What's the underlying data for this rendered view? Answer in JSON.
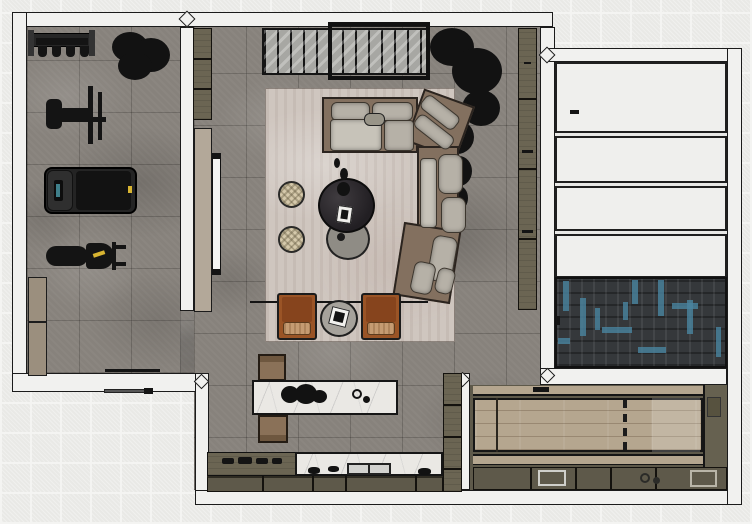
{
  "meta": {
    "view": "top-down-floorplan-render",
    "text_visible": "none"
  },
  "palette": {
    "bg0": "#f4f4f2",
    "bg1": "#e9e9e6",
    "ink": "#1b1b1b",
    "wall": "#f1f1ef",
    "stone": "#87827c",
    "rug": "#cfc6bf",
    "olive": "#6b6553",
    "olive2": "#5e594a",
    "sofa": "#83705f",
    "cushion": "#b6b1a7",
    "cushionL": "#c7c3b9",
    "leather": "#9a5426",
    "leatherD": "#86441d",
    "leatherS": "#c59b72",
    "pouf": "#d5c9ab",
    "tableDark": "#2c292c",
    "tableGray": "#8f8c85",
    "marble": "#eae8e4",
    "wood": "#b5a68f",
    "woodBench": "#8a7158",
    "tan": "#b3a899",
    "tv": "#f4f4f2",
    "herrBase": "#35383b",
    "herrTeal": "#4a84a0",
    "slab": "#efefed",
    "yellow": "#d8b431"
  },
  "scene": {
    "rooms": {
      "gym": "gym room",
      "living": "living room",
      "kitchen": "kitchen zone",
      "stair_hall": "stair hall",
      "entry": "parquet entry",
      "utility": "utility room"
    },
    "items": {
      "weight_rack": "dumbbell rack",
      "gym_plant": "potted plant",
      "cable_machine": "cable weight machine",
      "treadmill": "treadmill",
      "workout_bench": "workout bench",
      "gym_cabinet": "storage cabinet",
      "wardrobe_nw": "tall cabinet",
      "slat_screen": "slatted screen",
      "window_frame": "framed window",
      "living_plant": "corner tree",
      "media_panel": "media wall panel",
      "tv": "wall tv",
      "rug": "area rug",
      "sofa": "sectional sofa",
      "pouf_1": "round pouf",
      "pouf_2": "round pouf",
      "coffee_table_dark": "round coffee table",
      "coffee_table_gray": "round side table",
      "armchair_left": "leather armchair",
      "armchair_right": "leather armchair",
      "side_table": "round occasional table",
      "bookshelf_east": "wall shelf unit",
      "island": "marble kitchen island",
      "island_bench_top": "wood stool",
      "island_bench_bottom": "wood stool",
      "cooktop_counter": "cooktop counter",
      "sink_counter": "marble sink counter",
      "base_cabinets": "base cabinets",
      "tall_cabinet": "tall pantry cabinet",
      "stairs": "staircase",
      "entry_floor": "parquet floor",
      "utility_table": "wood work surface",
      "utility_cabinets": "utility cabinets",
      "utility_sink": "utility sink"
    }
  }
}
